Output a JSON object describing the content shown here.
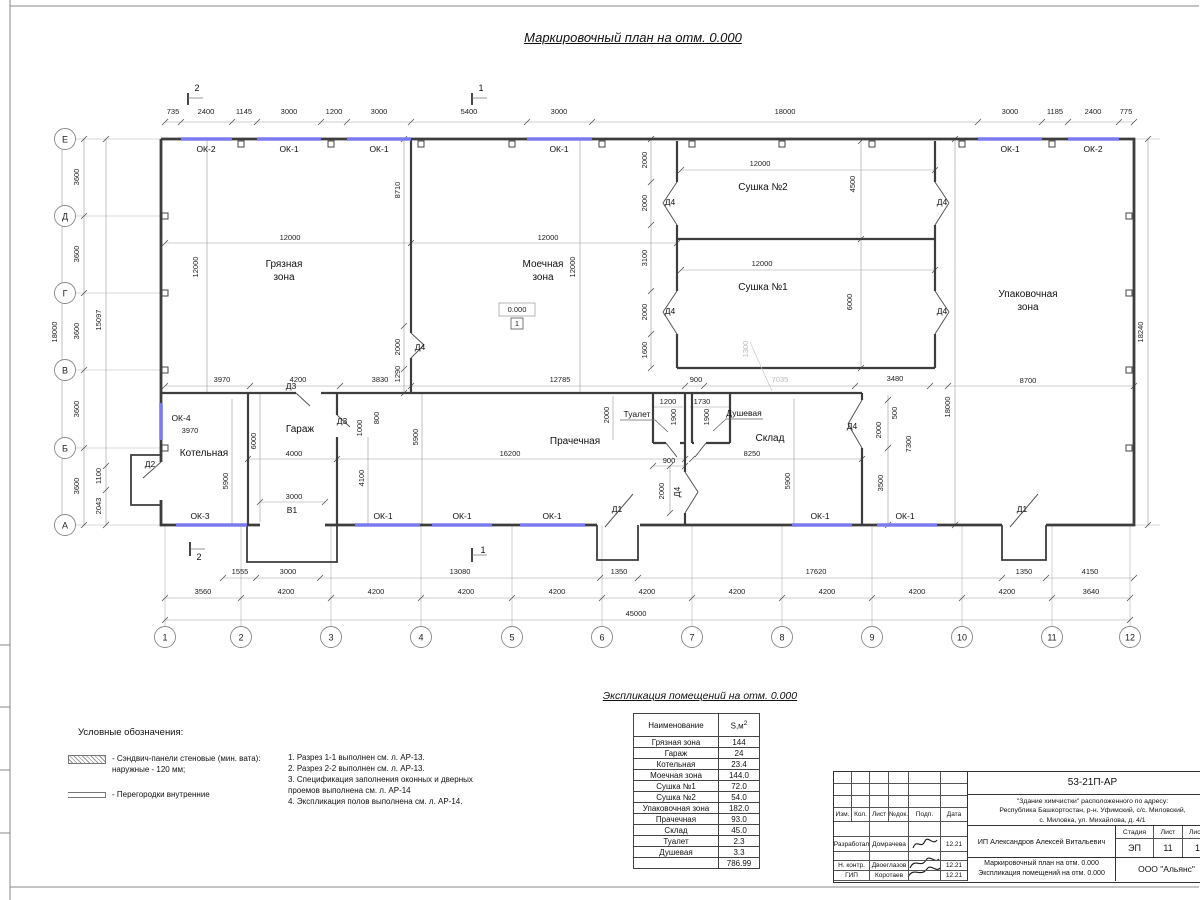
{
  "sheet": {
    "plan_title": "Маркировочный план на отм. 0.000"
  },
  "plan": {
    "grid_letters": [
      "Е",
      "Д",
      "Г",
      "В",
      "Б",
      "А"
    ],
    "grid_numbers": [
      "1",
      "2",
      "3",
      "4",
      "5",
      "6",
      "7",
      "8",
      "9",
      "10",
      "11",
      "12"
    ],
    "top_dims": [
      "735",
      "2400",
      "1145",
      "3000",
      "1200",
      "3000",
      "5400",
      "3000",
      "18000",
      "3000",
      "1185",
      "2400",
      "775"
    ],
    "row1_dims": [
      "1555",
      "3000",
      "13080",
      "1350",
      "17620",
      "1350",
      "4150"
    ],
    "row2_dims": [
      "3560",
      "4200",
      "4200",
      "4200",
      "4200",
      "4200",
      "4200",
      "4200",
      "4200",
      "4200",
      "3640"
    ],
    "total_dim": "45000",
    "left_dims": [
      "3600",
      "3600",
      "3600",
      "3600",
      "3600"
    ],
    "left_total": "18000",
    "left_aux": [
      "15097",
      "1100",
      "2043"
    ],
    "right_total": "18240",
    "windows": {
      "ok1": "ОК-1",
      "ok2": "ОК-2",
      "ok3": "ОК-3",
      "ok4": "ОК-4"
    },
    "doors": {
      "d1": "Д1",
      "d2": "Д2",
      "d3": "Д3",
      "d4": "Д4",
      "v1": "В1"
    },
    "sections": {
      "s1": "1",
      "s2": "2"
    },
    "elev": "0.000",
    "floor_mark": "1",
    "rooms": {
      "dirty1": "Грязная",
      "dirty2": "зона",
      "wash1": "Моечная",
      "wash2": "зона",
      "dry2": "Сушка №2",
      "dry1": "Сушка №1",
      "pack1": "Упаковочная",
      "pack2": "зона",
      "boiler": "Котельная",
      "garage": "Гараж",
      "laundry": "Прачечная",
      "wc": "Туалет",
      "shower": "Душевая",
      "storage": "Склад"
    },
    "dims": {
      "dirty_w": "12000",
      "dirty_h": "12000",
      "dirty_r": "8710",
      "dirty_b1": "3970",
      "dirty_b2": "4200",
      "dirty_b3": "3830",
      "d4_off1": "2000",
      "d4_off2": "1290",
      "wash_w": "12000",
      "wash_h": "12000",
      "wash_b": "12785",
      "dry_col1": "2000",
      "dry_col2": "2000",
      "dry_col3": "3100",
      "dry_col4": "2000",
      "dry_col5": "1600",
      "dry2_w": "12000",
      "dry2_h": "4500",
      "dry1_w": "12000",
      "dry1_h": "6000",
      "dry_b1": "900",
      "dry_b2": "3480",
      "faint1": "1300",
      "faint2": "7035",
      "pack_w": "8700",
      "pack_h": "18000",
      "laundry_w": "16200",
      "laundry_t": "2000",
      "laundry_h": "5900",
      "wc_w": "1200",
      "wc_h": "1900",
      "sh_w": "1730",
      "sh_h": "1900",
      "cor_w": "900",
      "cor_h": "2000",
      "stor_w": "8250",
      "stor_h": "5900",
      "stor_d1": "500",
      "stor_d2": "2000",
      "stor_d3": "7300",
      "stor_d4": "3500",
      "boiler_w": "3970",
      "boiler_h": "5900",
      "gar_h": "6000",
      "gar_w": "4000",
      "gar_r": "4100",
      "gar_d1": "1000",
      "gar_d2": "800",
      "gar_gate": "3000"
    }
  },
  "legend": {
    "title": "Условные обозначения:",
    "i1a": "- Сэндвич-панели стеновые (мин. вата):",
    "i1b": "наружные - 120 мм;",
    "i2": "- Перегородки внутренние"
  },
  "notes": [
    "1. Разрез 1-1 выполнен см. л. АР-13.",
    "2. Разрез 2-2 выполнен см. л. АР-13.",
    "3. Спецификация заполнения оконных и дверных",
    "проемов выполнена см. л. АР-14",
    "4. Экспликация полов выполнена см. л. АР-14."
  ],
  "schedule": {
    "title": "Экспликация помещений на отм. 0.000",
    "col_name": "Наименование",
    "col_area": "S,м",
    "col_area_sup": "2",
    "rows": [
      [
        "Грязная зона",
        "144"
      ],
      [
        "Гараж",
        "24"
      ],
      [
        "Котельная",
        "23.4"
      ],
      [
        "Моечная зона",
        "144.0"
      ],
      [
        "Сушка №1",
        "72.0"
      ],
      [
        "Сушка №2",
        "54.0"
      ],
      [
        "Упаковочная зона",
        "182.0"
      ],
      [
        "Прачечная",
        "93.0"
      ],
      [
        "Склад",
        "45.0"
      ],
      [
        "Туалет",
        "2.3"
      ],
      [
        "Душевая",
        "3.3"
      ]
    ],
    "total": "786.99"
  },
  "titleblock": {
    "doc_number": "53-21П-АР",
    "addr1": "\"Здание химчистки\" расположенного по адресу:",
    "addr2": "Республика Башкортостан, р-н. Уфимский, с/с. Миловский,",
    "addr3": "с. Миловка, ул. Михайлова, д. 4/1",
    "cols": [
      "Изм.",
      "Кол.",
      "Лист",
      "№док.",
      "Подп.",
      "Дата"
    ],
    "role1": "Разработал",
    "name1": "Домрачева",
    "date1": "12.21",
    "role2": "Н. контр.",
    "name2": "Двоеглазов",
    "date2": "12.21",
    "role3": "ГИП",
    "name3": "Коротаев",
    "date3": "12.21",
    "client": "ИП Александров Алексей Витальевич",
    "stage_label": "Стадия",
    "sheet_label": "Лист",
    "sheets_label": "Листов",
    "stage": "ЭП",
    "sheet_no": "11",
    "sheets": "14",
    "title1": "Маркировочный план на отм. 0.000",
    "title2": "Экспликация помещений на отм. 0.000",
    "company": "ООО \"Альянс\""
  }
}
